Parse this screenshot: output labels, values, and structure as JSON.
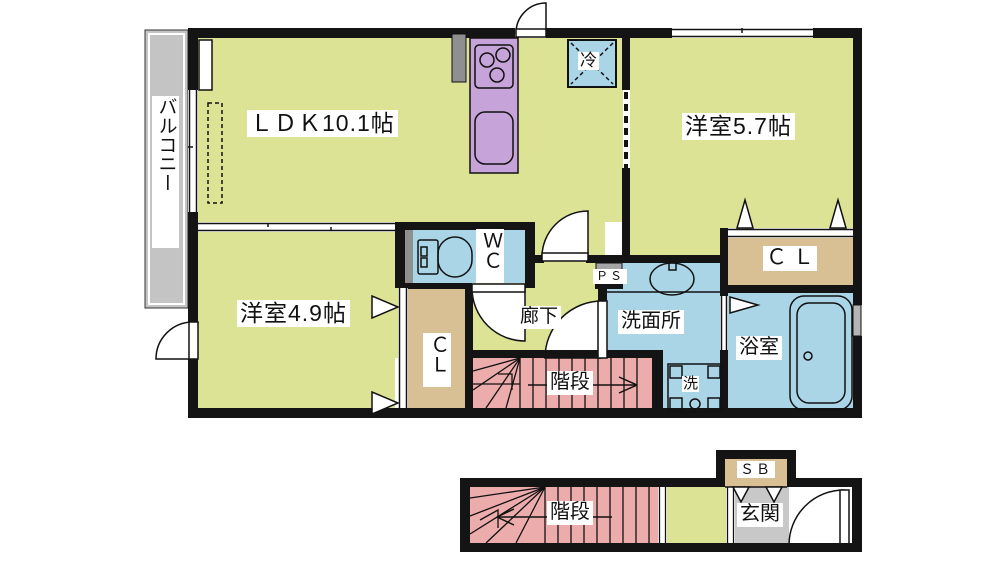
{
  "floor2": {
    "balcony": {
      "label": "バルコニー"
    },
    "ldk": {
      "label": "ＬＤＫ10.1帖"
    },
    "bedroom_57": {
      "label": "洋室5.7帖"
    },
    "bedroom_49": {
      "label": "洋室4.9帖"
    },
    "wc": {
      "label": "ＷＣ"
    },
    "closet_south": {
      "label": "ＣＬ"
    },
    "closet_east": {
      "label": "Ｃ Ｌ"
    },
    "hallway": {
      "label": "廊下"
    },
    "washroom": {
      "label": "洗面所"
    },
    "bathroom": {
      "label": "浴室"
    },
    "laundry": {
      "label": "洗"
    },
    "pipe_space": {
      "label": "ＰＳ"
    },
    "refrigerator": {
      "label": "冷"
    },
    "stairs": {
      "label": "階段"
    }
  },
  "floor1": {
    "stairs": {
      "label": "階段"
    },
    "entrance": {
      "label": "玄関"
    },
    "shoe_box": {
      "label": "ＳＢ"
    }
  },
  "colors": {
    "room_yellow": "#dce394",
    "wet_blue": "#a9d5e7",
    "stairs_pink": "#ecacac",
    "closet_tan": "#d8bf94",
    "kitchen_purple": "#c6a3d9",
    "balcony_gray": "#c4c4c4",
    "entrance_gray": "#c8c8c8",
    "wall_black": "#141414"
  }
}
